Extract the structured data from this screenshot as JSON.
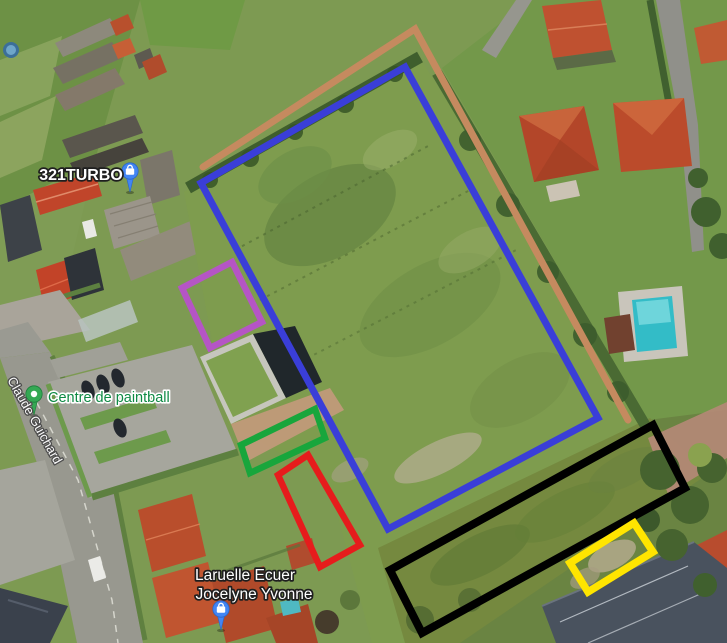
{
  "map": {
    "view": "satellite",
    "size": {
      "width": 727,
      "height": 643
    },
    "poi_labels": [
      {
        "id": "321turbo",
        "text": "321TURBO",
        "kind": "business",
        "text_color": "#ffffff",
        "halo_color": "#1f1f1f",
        "halo_width": 3.4,
        "font_size": 16,
        "weight": "bold",
        "x": 81,
        "y": 180,
        "anchor": "middle",
        "rotation": 0,
        "interactable": true
      },
      {
        "id": "centre-de-paintball",
        "text": "Centre de paintball",
        "kind": "poi",
        "text_color": "#0e8a44",
        "halo_color": "#ffffff",
        "halo_width": 3.2,
        "font_size": 14.5,
        "weight": "normal",
        "x": 48,
        "y": 402,
        "anchor": "start",
        "rotation": 0,
        "interactable": true
      },
      {
        "id": "laruelle-line1",
        "text": "Laruelle Ecuer",
        "kind": "business",
        "text_color": "#ffffff",
        "halo_color": "#1f1f1f",
        "halo_width": 3.4,
        "font_size": 15.5,
        "weight": "normal",
        "x": 245,
        "y": 580,
        "anchor": "middle",
        "rotation": 0,
        "interactable": true
      },
      {
        "id": "laruelle-line2",
        "text": "Jocelyne Yvonne",
        "kind": "business",
        "text_color": "#ffffff",
        "halo_color": "#1f1f1f",
        "halo_width": 3.4,
        "font_size": 15.5,
        "weight": "normal",
        "x": 254,
        "y": 599,
        "anchor": "middle",
        "rotation": 0,
        "interactable": true
      },
      {
        "id": "street-claude-guichard",
        "text": "Claude Guichard",
        "kind": "street",
        "text_color": "#fafafa",
        "halo_color": "#4d4d4d",
        "halo_width": 2.6,
        "font_size": 13,
        "weight": "normal",
        "x": 7,
        "y": 380,
        "anchor": "start",
        "rotation": 60.5,
        "interactable": false
      }
    ],
    "markers": [
      {
        "id": "pin-321turbo",
        "glyph": "shopping-bag",
        "color": "#4285f4",
        "border": "#2a66c8",
        "x": 130,
        "y": 171
      },
      {
        "id": "pin-centre-de-paintball",
        "glyph": "dot",
        "color": "#34a853",
        "border": "#1e7e3c",
        "x": 34,
        "y": 394
      },
      {
        "id": "pin-laruelle",
        "glyph": "shopping-bag",
        "color": "#4285f4",
        "border": "#2a66c8",
        "x": 221,
        "y": 609
      }
    ],
    "overlay_shapes": [
      {
        "id": "orange-line",
        "kind": "polyline",
        "stroke": "#c58a5f",
        "stroke_width": 7,
        "points": "203,167 415,29 628,420"
      },
      {
        "id": "blue-rectangle",
        "kind": "polygon",
        "stroke": "#3a3ed8",
        "stroke_width": 7,
        "points": "201,183 405,67 598,418 388,529"
      },
      {
        "id": "purple-rectangle",
        "kind": "polygon",
        "stroke": "#b555c5",
        "stroke_width": 6.5,
        "points": "232,262 262,322 210,348 182,288"
      },
      {
        "id": "green-rectangle",
        "kind": "polygon",
        "stroke": "#18a63c",
        "stroke_width": 6.5,
        "points": "315,409 325,438 250,473 241,445"
      },
      {
        "id": "red-rectangle",
        "kind": "polygon",
        "stroke": "#e61c1c",
        "stroke_width": 6.5,
        "points": "308,455 278,475 320,567 360,545"
      },
      {
        "id": "black-rectangle",
        "kind": "polygon",
        "stroke": "#000000",
        "stroke_width": 8,
        "points": "653,425 685,488 422,633 390,570"
      },
      {
        "id": "yellow-rectangle",
        "kind": "polygon",
        "stroke": "#ffe500",
        "stroke_width": 7.5,
        "points": "634,523 653,552 588,592 570,563"
      }
    ]
  }
}
